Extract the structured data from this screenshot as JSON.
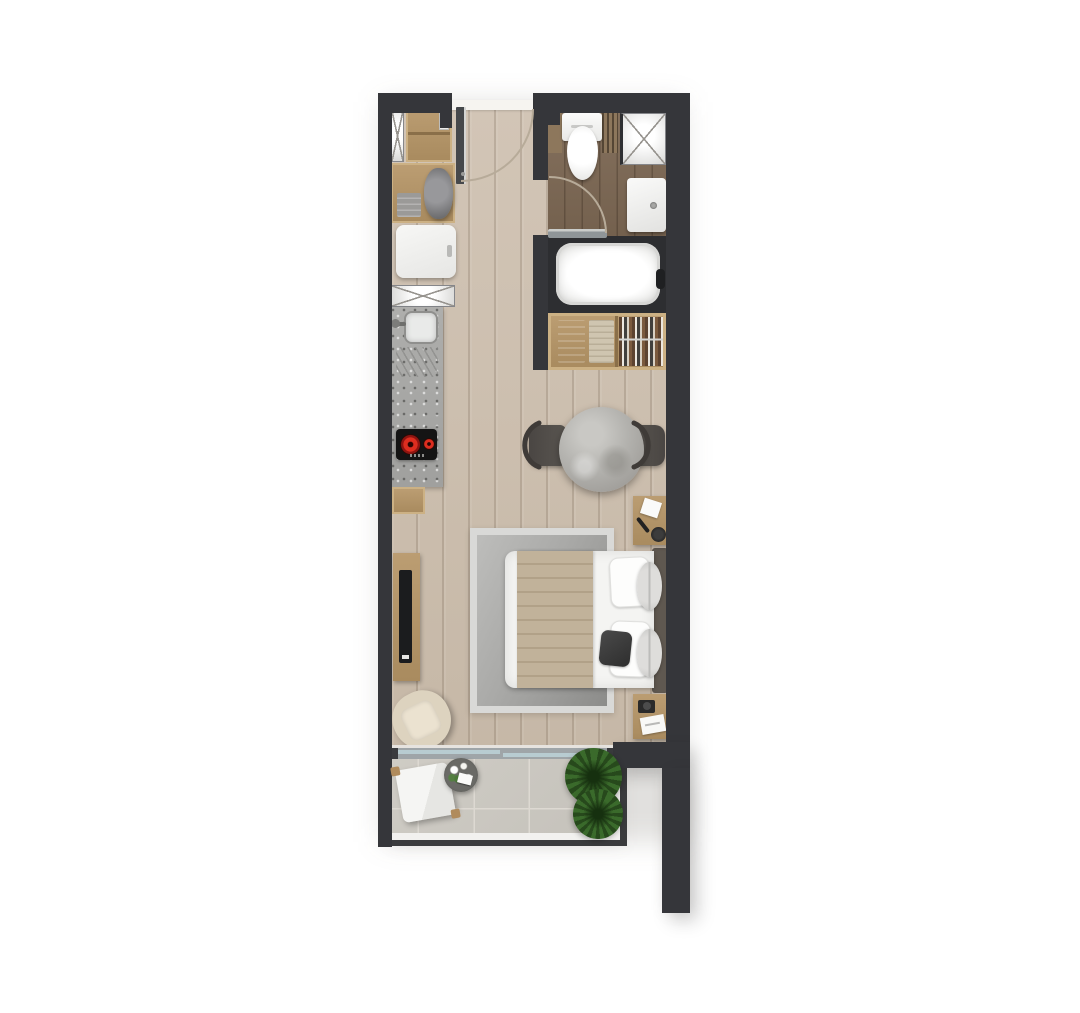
{
  "meta": {
    "type": "floor-plan",
    "description": "Top-down rendered floor plan of a studio apartment with balcony, white background, no text labels",
    "canvas": {
      "width": 1080,
      "height": 1013
    }
  },
  "rooms": [
    {
      "id": "entry",
      "label": "Entry"
    },
    {
      "id": "kitchenette",
      "label": "Kitchenette"
    },
    {
      "id": "bathroom",
      "label": "Bathroom"
    },
    {
      "id": "wardrobe-closet",
      "label": "Wardrobe closet"
    },
    {
      "id": "main-living-bedroom",
      "label": "Living / bedroom area"
    },
    {
      "id": "balcony",
      "label": "Balcony terrace"
    }
  ],
  "fixtures": [
    "entry-door",
    "entry-closet",
    "ventilation-shaft",
    "laundry-counter",
    "towels",
    "refrigerator",
    "kitchen-counter",
    "kitchen-sink",
    "kitchen-faucet",
    "drainboard",
    "cooktop",
    "base-cabinet",
    "toilet",
    "washbasin",
    "bathtub",
    "bathtub-faucet",
    "bathroom-door",
    "wardrobe",
    "folded-clothes",
    "hanging-clothes",
    "dining-table",
    "dining-chair-left",
    "dining-chair-right",
    "double-bed",
    "headboard",
    "throw-blanket",
    "pillows",
    "area-rug",
    "nightstand-top",
    "nightstand-bottom",
    "table-lamp",
    "notepad",
    "book",
    "camera",
    "tv-console",
    "television",
    "armchair",
    "sliding-glass-door",
    "lounge-chair",
    "side-table-with-flowers",
    "potted-plant-1",
    "potted-plant-2",
    "balcony-railing"
  ],
  "palette": {
    "background": "#ffffff",
    "wall": "#35363a",
    "floor_main_light": "#d2c5b6",
    "floor_main_dark": "#c6b8a7",
    "floor_bath_light": "#84705d",
    "floor_bath_dark": "#73604d",
    "wood_light": "#bb9d72",
    "wood_dark": "#a98b5f",
    "wood_frame": "#ccb184",
    "granite_light": "#aeaeac",
    "granite_dark": "#a0a09e",
    "fixture_white": "#f4f4f2",
    "rug_border": "#d9d9d7",
    "blanket": "#c1b29a",
    "blanket_stripe": "#b1a188",
    "headboard": "#5f5850",
    "marble": "#b4b3af",
    "tile": "#cfccc5",
    "tile_grout": "#ddd9d2",
    "plant": "#3a6a2b",
    "plant_dark": "#27491c",
    "glass": "#b8ccd1",
    "glass_frame": "#9fa5a8",
    "glass_cap": "#3a3b3e",
    "armchair_shell": "#ddd3bf",
    "armchair_cushion": "#ebe2d0",
    "cooktop": "#141414",
    "burner": "#dd2d1f",
    "door_leaf": "#46484b",
    "door_leaf_edge": "#d5d5d3",
    "arc_line": "#b7ab99",
    "threshold": "#f6f4f0",
    "railing": "#3a3b3d"
  }
}
